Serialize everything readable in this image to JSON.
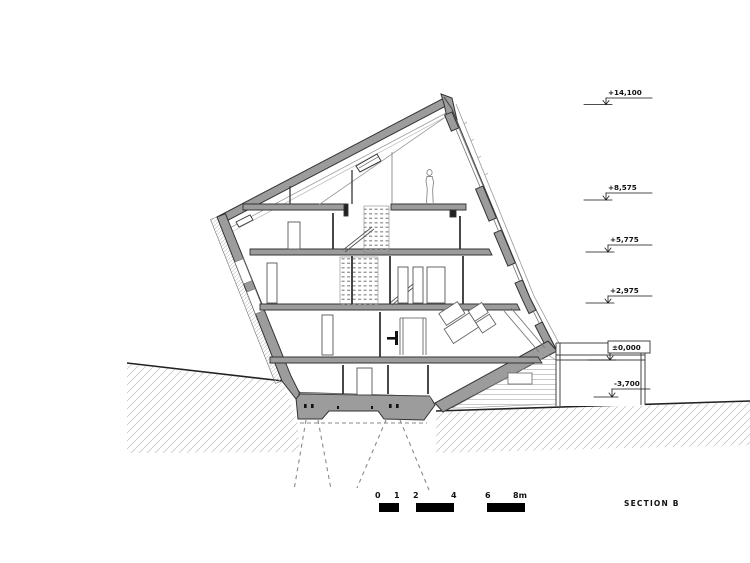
{
  "drawing": {
    "title": "SECTION B",
    "levels": [
      {
        "id": "roof",
        "label": "+14,100"
      },
      {
        "id": "attic",
        "label": "+8,575"
      },
      {
        "id": "floor3",
        "label": "+5,775"
      },
      {
        "id": "floor2",
        "label": "+2,975"
      },
      {
        "id": "ground",
        "label": "±0,000"
      },
      {
        "id": "basement",
        "label": "-3,700"
      }
    ],
    "scale_bar": {
      "unit": "m",
      "labels": [
        "0",
        "1",
        "2",
        "4",
        "6",
        "8m"
      ]
    },
    "colors": {
      "poche": "#9c9c9c",
      "line": "#333333",
      "hatch": "#c8c8c8",
      "background": "#ffffff"
    }
  }
}
